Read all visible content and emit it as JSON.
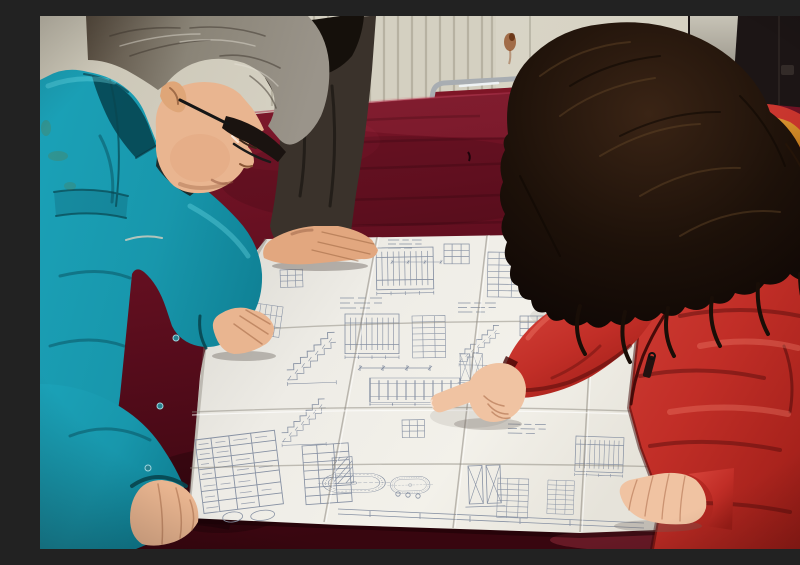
{
  "meta": {
    "type": "photograph",
    "title": "Workers reviewing a construction blueprint",
    "description": "Photograph of three people leaning over a large folded construction blueprint spread on a dark red velvet covered table. A gray-haired man with glasses in a teal work jacket studies the drawing at left, a colleague in a dark jacket rests a hand on the sheet behind him, and a woman with long dark wavy hair in a red padded coat with an orange fur-trimmed hood points at a detail with her right index finger.",
    "setting": "Room with a white finned radiator wall, a faint rust stain, a dark door panel at right, and a red upholstered chrome chair behind the table."
  },
  "people": [
    {
      "id": "engineer-left",
      "description": "Middle-aged man, gray hair, black-rimmed glasses, teal work jacket, both hands on the drawing"
    },
    {
      "id": "colleague-behind",
      "description": "Person in dark brown jacket with black hair, hand resting on the top edge of the drawing"
    },
    {
      "id": "woman-right",
      "description": "Woman with long dark wavy hair, red padded coat with orange fur hood trim, pointing with right index finger, left hand resting on the sheet"
    }
  ],
  "objects": {
    "blueprint": "Large folded white engineering drawing with stair sections, elevation details, schedule tables, a stamped title block and an oval tank detail",
    "table": "Table draped in dark crimson velvet",
    "radiator": "White column radiator along the back wall",
    "chair": "Chrome tube chair with red velvet upholstery",
    "door": "Dark door panel with small handle at upper right",
    "stain": "Rust drip stain on the wall"
  },
  "palette": {
    "wall": "#d9d5c7",
    "wallDark": "#c9c4b4",
    "radiatorLine": "#b7b2a2",
    "doorPanel": "#1c1515",
    "doorEdge": "#c7c3b6",
    "rust": "#8f4a1e",
    "chrome": "#a8adb2",
    "chairRed": "#7e1526",
    "velvetA": "#7d1628",
    "velvetB": "#6b1123",
    "velvetC": "#550c1b",
    "velvetD": "#38060f",
    "paperLight": "#f3f1ea",
    "paperDark": "#d8d6cf",
    "ink": "#8791a3",
    "teal": "#1ba2b8",
    "tealDark": "#0e7e92",
    "tealLight": "#55c8da",
    "skin": "#e9b590",
    "skinDeep": "#c08968",
    "hairGray": "#8f8a7d",
    "hairGrayDark": "#554a3d",
    "darkJacket": "#3a322b",
    "hairBlack": "#15100b",
    "hairWomanDark": "#0d0604",
    "hairWomanMid": "#1d1109",
    "hairWomanLight": "#3a2415",
    "furA": "#e8a43c",
    "furB": "#8a4c12",
    "coatA": "#d8453c",
    "coatB": "#9c1d17",
    "coatShadow": "#5f0f0c"
  }
}
